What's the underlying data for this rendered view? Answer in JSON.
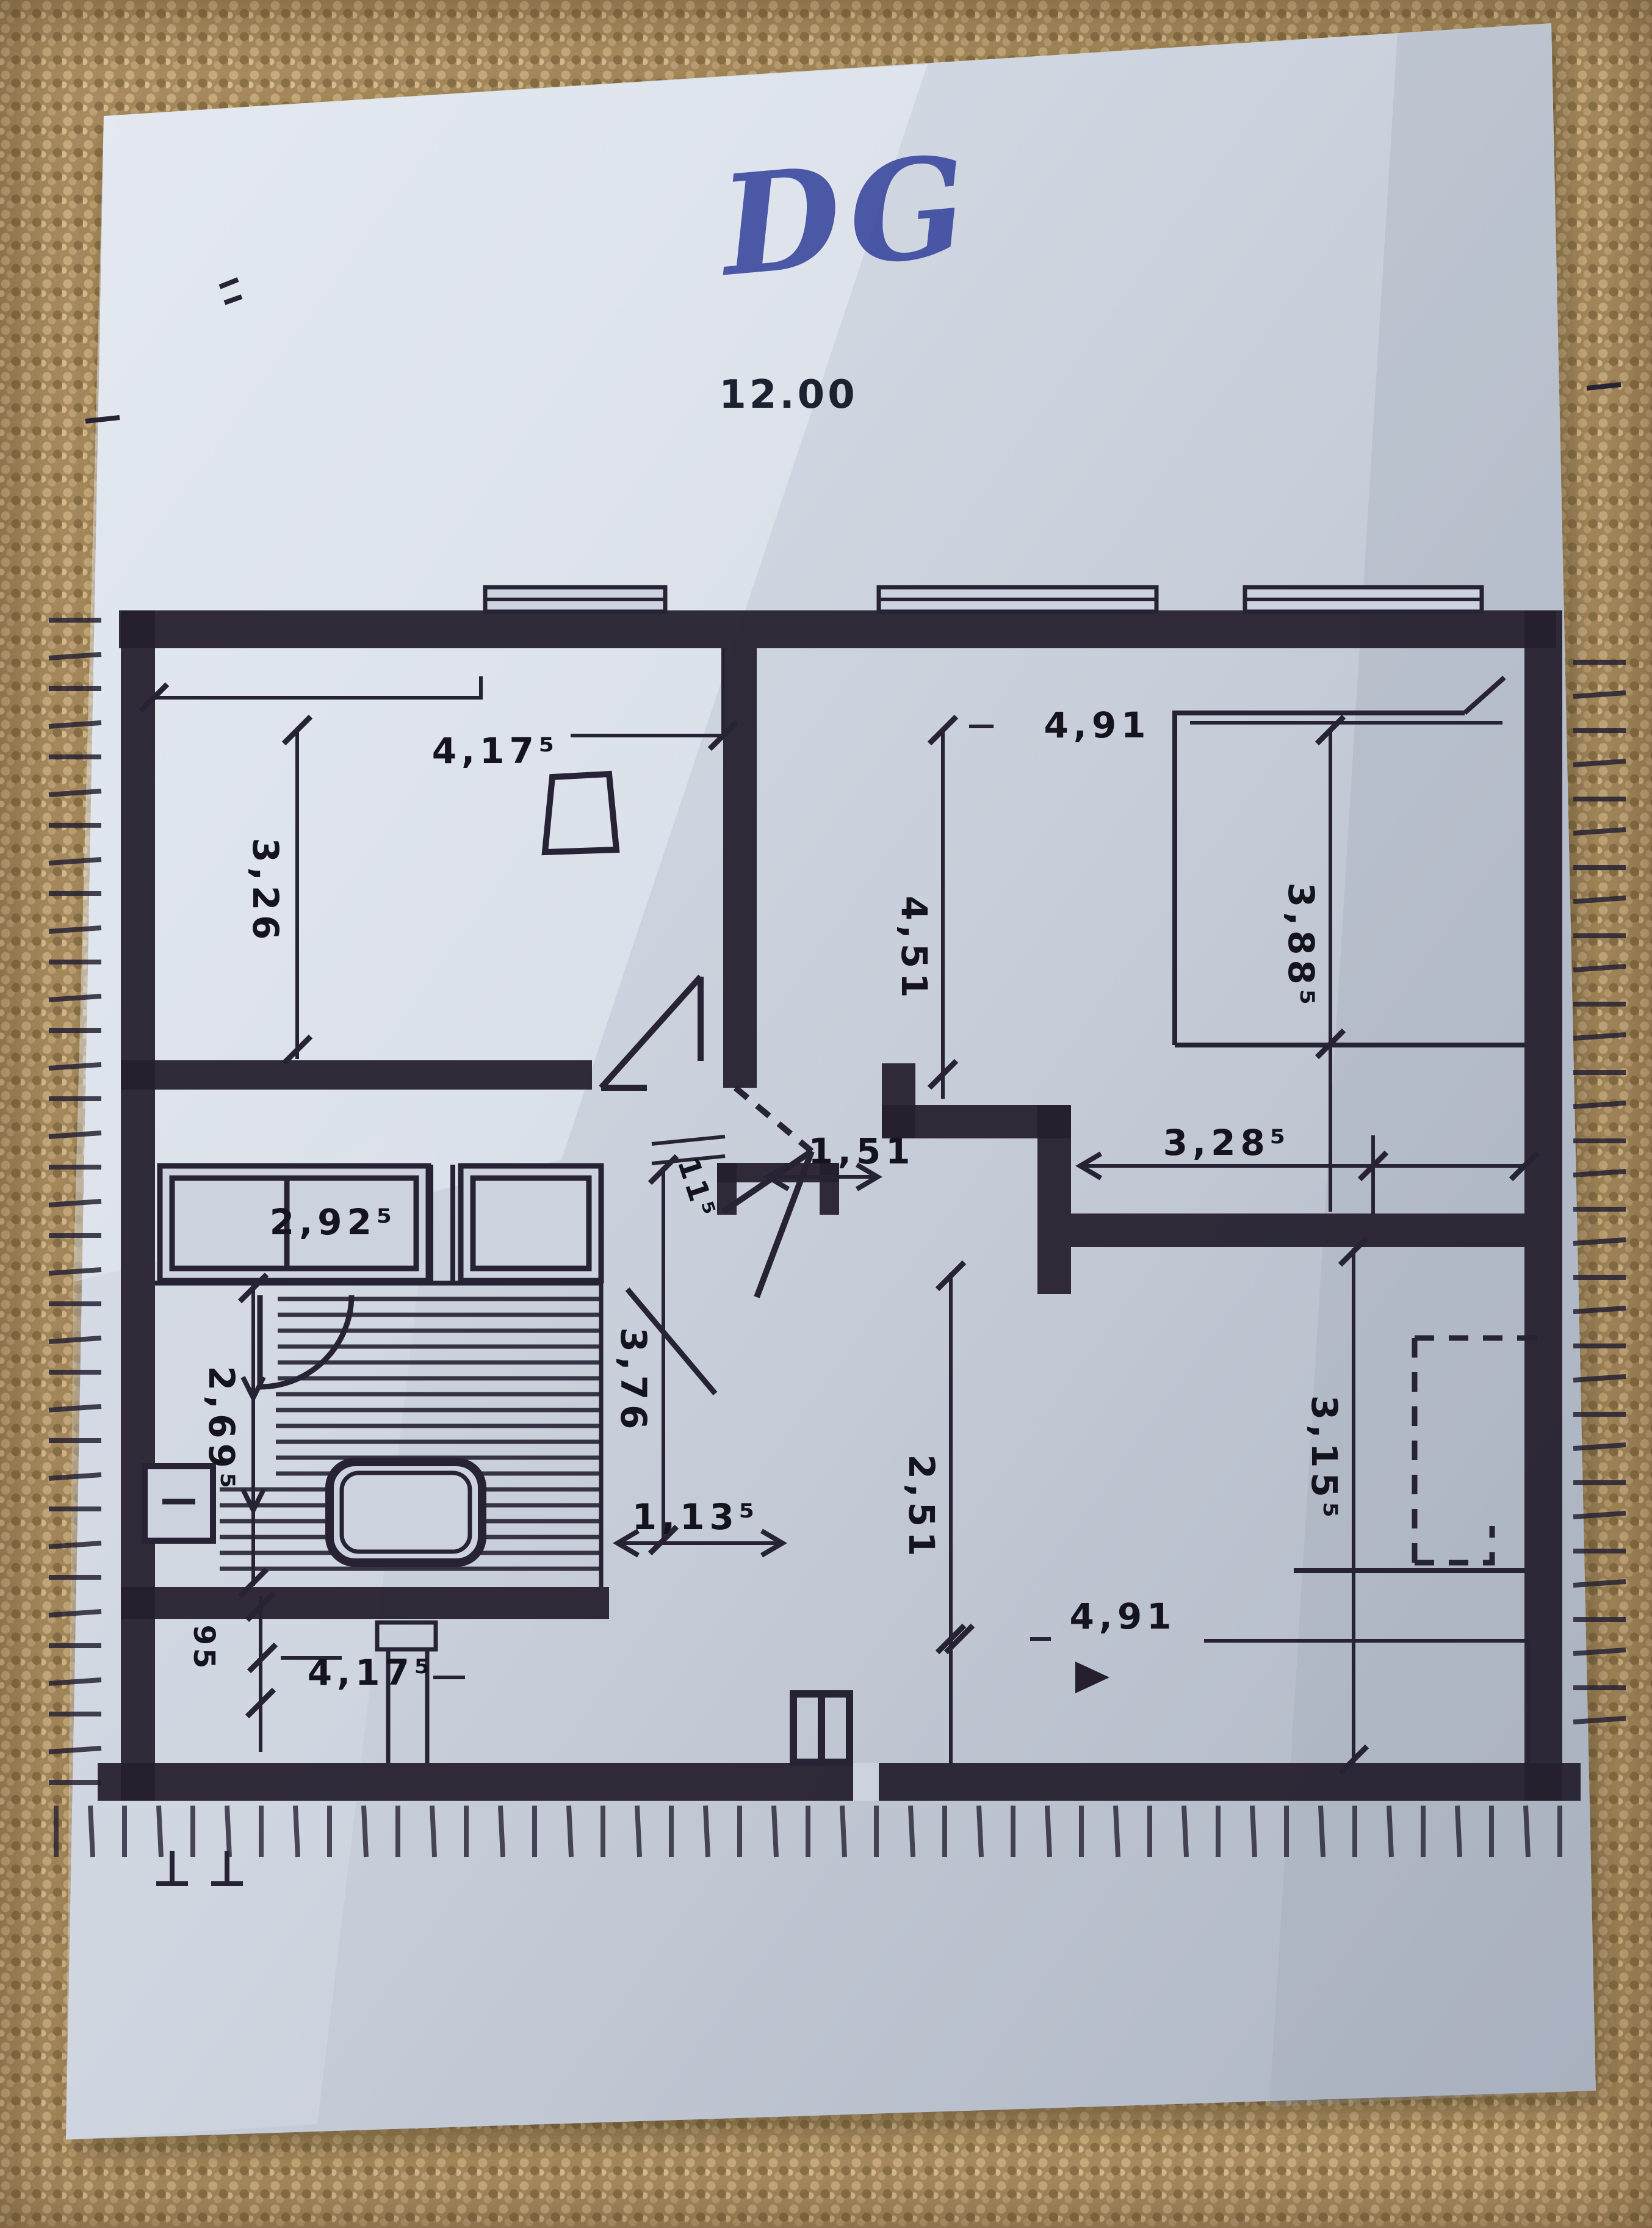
{
  "photo": {
    "handwritten_floor_label": "DG",
    "plan_total_width": "12.00"
  },
  "dims": {
    "top_left_width": "4,17⁵",
    "top_right_width": "4,91",
    "left_room_height": "3,26",
    "center_height": "4,51",
    "right_room_height": "3,88⁵",
    "closet_width": "2,92⁵",
    "wall_thickness": "11⁵",
    "stair_opening_width": "1,51",
    "right_hall_width": "3,28⁵",
    "bath_height": "2,69⁵",
    "corridor_height": "3,76",
    "bottom_center_height": "2,51",
    "bottom_right_height": "3,15⁵",
    "bottom_door_width": "1,13⁵",
    "bottom_strip_width": "95",
    "bottom_left_width": "4,17⁵",
    "bottom_right_width": "4,91"
  }
}
